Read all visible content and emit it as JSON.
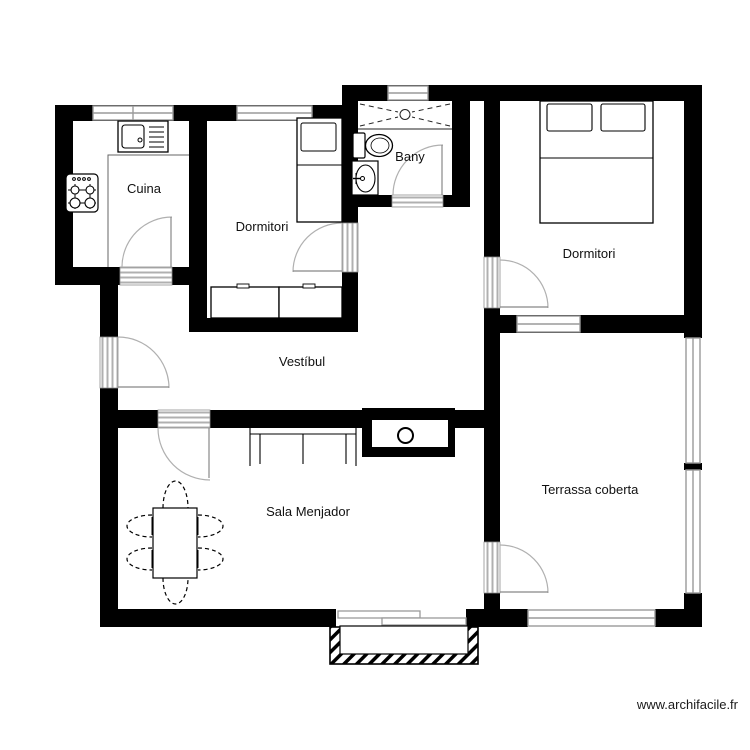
{
  "page": {
    "watermark": "www.archifacile.fr"
  },
  "rooms": {
    "cuina": {
      "label": "Cuina"
    },
    "dormitori_1": {
      "label": "Dormitori"
    },
    "bany": {
      "label": "Bany"
    },
    "dormitori_2": {
      "label": "Dormitori"
    },
    "vestibul": {
      "label": "Vestíbul"
    },
    "sala_menjador": {
      "label": "Sala Menjador"
    },
    "terrassa_coberta": {
      "label": "Terrassa coberta"
    }
  },
  "legend": {
    "furniture": [
      "sink",
      "stove",
      "counter",
      "single-bed",
      "wardrobe",
      "shower",
      "toilet",
      "washbasin",
      "double-bed",
      "sofa",
      "dining-table",
      "chairs",
      "fireplace",
      "sliding-door",
      "porch-steps"
    ]
  },
  "colors": {
    "wall": "#000000",
    "window_frame": "#9a9a9a",
    "door_threshold": "#b0b0b0",
    "door_arc": "#b0b0b0",
    "text": "#111111",
    "background": "#ffffff"
  }
}
